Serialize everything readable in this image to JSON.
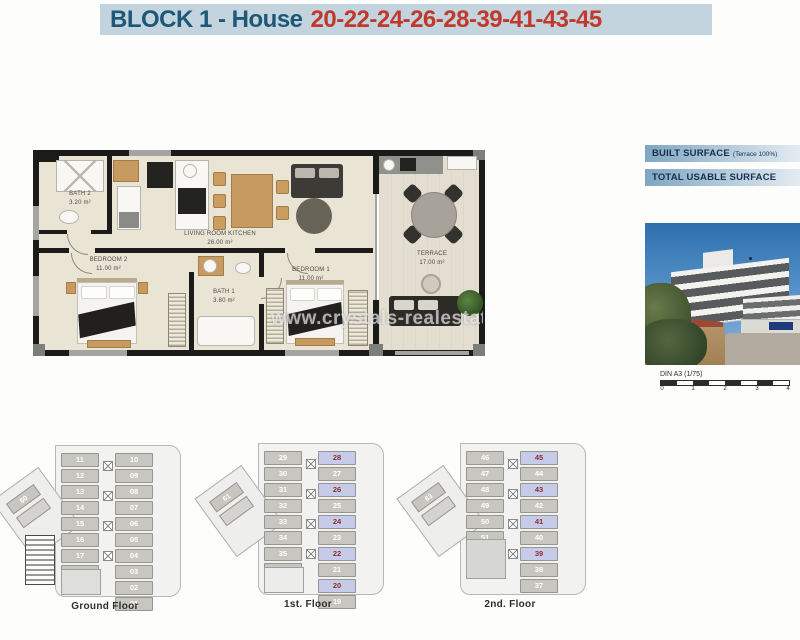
{
  "header": {
    "title_prefix": "BLOCK 1 - House",
    "title_numbers": "20-22-24-26-28-39-41-43-45"
  },
  "colors": {
    "header_bg": "#c3d4de",
    "title_color": "#1d5878",
    "numbers_color": "#c0392b",
    "highlight_cell_bg": "#c5cbe8",
    "highlight_cell_text": "#8f2d28"
  },
  "floor_plan": {
    "rooms": [
      {
        "name": "BATH 2",
        "area": "3.20 m²"
      },
      {
        "name": "LIVING ROOM KITCHEN",
        "area": "26.00 m²"
      },
      {
        "name": "BEDROOM 2",
        "area": "11.00 m²"
      },
      {
        "name": "BATH 1",
        "area": "3.80 m²"
      },
      {
        "name": "BEDROOM 1",
        "area": "11.00 m²"
      },
      {
        "name": "TERRACE",
        "area": "17.00 m²"
      }
    ],
    "watermark": "www.crystals-realestate"
  },
  "side_panel": {
    "built_surface_label": "BUILT SURFACE",
    "built_surface_note": "(Terrace 100%)",
    "total_usable_label": "TOTAL USABLE SURFACE",
    "scale_label": "DIN A3 (1/75)",
    "scale_ticks": [
      "0",
      "1",
      "2",
      "3",
      "4"
    ]
  },
  "floors": [
    {
      "label": "Ground Floor",
      "left_units": [
        "11",
        "12",
        "13",
        "14",
        "15",
        "16",
        "17",
        "18"
      ],
      "right_units": [
        "10",
        "09",
        "08",
        "07",
        "06",
        "05",
        "04",
        "03",
        "02",
        "01"
      ],
      "highlighted": [],
      "annex_unit": "60"
    },
    {
      "label": "1st. Floor",
      "left_units": [
        "29",
        "30",
        "31",
        "32",
        "33",
        "34",
        "35",
        "36"
      ],
      "right_units": [
        "28",
        "27",
        "26",
        "25",
        "24",
        "23",
        "22",
        "21",
        "20",
        "19"
      ],
      "highlighted": [
        "28",
        "26",
        "24",
        "22",
        "20"
      ],
      "annex_unit": "61"
    },
    {
      "label": "2nd. Floor",
      "left_units": [
        "46",
        "47",
        "48",
        "49",
        "50",
        "51"
      ],
      "right_units": [
        "45",
        "44",
        "43",
        "42",
        "41",
        "40",
        "39",
        "38",
        "37"
      ],
      "highlighted": [
        "45",
        "43",
        "41",
        "39"
      ],
      "annex_unit": "63"
    }
  ]
}
